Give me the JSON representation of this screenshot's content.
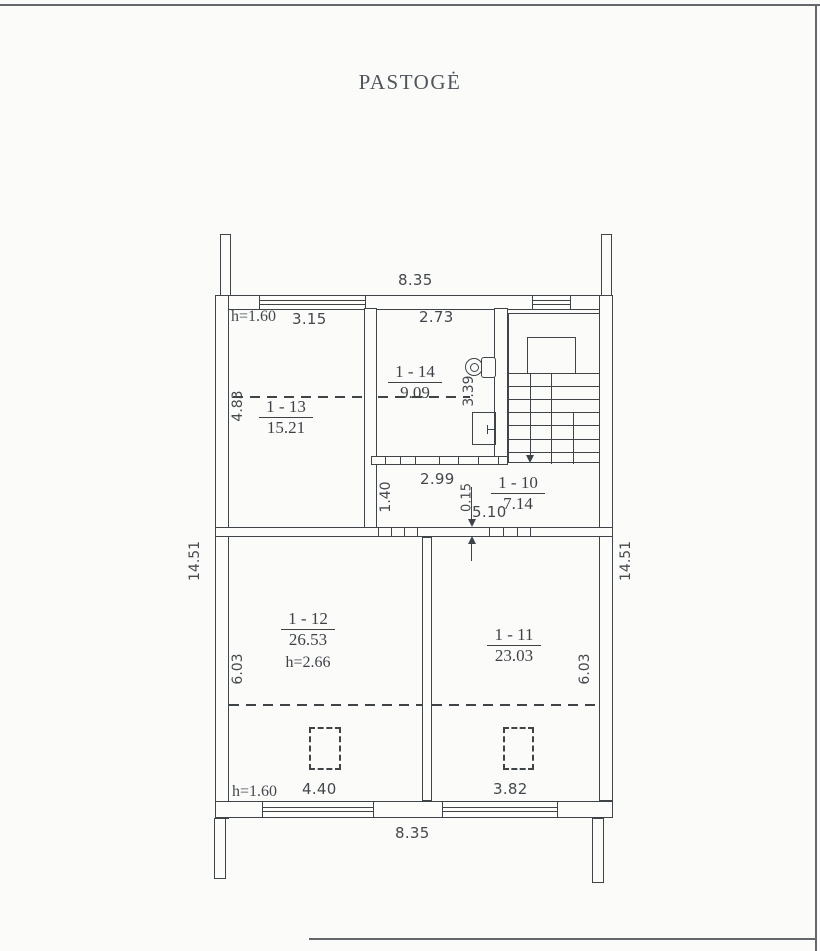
{
  "page": {
    "title": "PASTOGĖ"
  },
  "rooms": {
    "r13": {
      "no": "1 - 13",
      "area": "15.21"
    },
    "r14": {
      "no": "1 - 14",
      "area": "9.09"
    },
    "r10": {
      "no": "1 - 10",
      "area": "7.14"
    },
    "r12": {
      "no": "1 - 12",
      "area": "26.53",
      "height": "h=2.66"
    },
    "r11": {
      "no": "1 - 11",
      "area": "23.03"
    }
  },
  "dims": {
    "top_width": "8.35",
    "bottom_width": "8.35",
    "left_height": "14.51",
    "right_height": "14.51",
    "attic_height_top": "h=1.60",
    "attic_height_bottom": "h=1.60",
    "r13_width": "3.15",
    "r13_depth": "4.83",
    "r14_width": "2.73",
    "r14_depth": "3.39",
    "corridor_width": "2.99",
    "corridor_depth": "1.40",
    "wall_thickness": "0.15",
    "hall_length": "5.10",
    "r12_depth": "6.03",
    "r11_depth": "6.03",
    "r12_width": "4.40",
    "r11_width": "3.82"
  },
  "colors": {
    "line": "#3f4449",
    "text": "#44484d",
    "background": "#fbfbfa"
  }
}
